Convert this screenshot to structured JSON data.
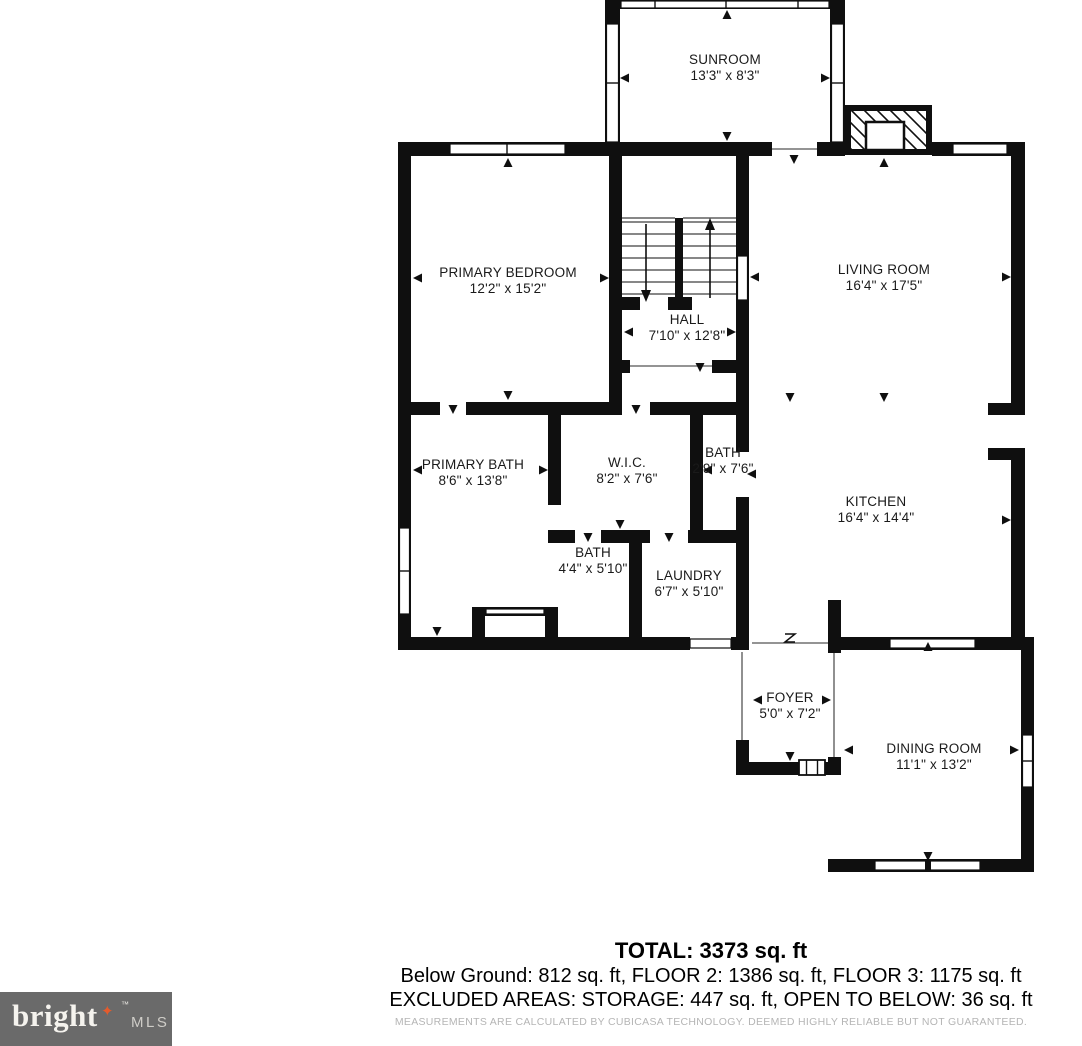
{
  "plan": {
    "rooms": [
      {
        "name": "SUNROOM",
        "dims": "13'3\" x 8'3\""
      },
      {
        "name": "PRIMARY BEDROOM",
        "dims": "12'2\" x 15'2\""
      },
      {
        "name": "LIVING ROOM",
        "dims": "16'4\" x 17'5\""
      },
      {
        "name": "HALL",
        "dims": "7'10\" x 12'8\""
      },
      {
        "name": "PRIMARY BATH",
        "dims": "8'6\" x 13'8\""
      },
      {
        "name": "W.I.C.",
        "dims": "8'2\" x 7'6\""
      },
      {
        "name": "BATH",
        "dims": "2'9\" x 7'6\""
      },
      {
        "name": "KITCHEN",
        "dims": "16'4\" x 14'4\""
      },
      {
        "name": "BATH",
        "dims": "4'4\" x 5'10\""
      },
      {
        "name": "LAUNDRY",
        "dims": "6'7\" x 5'10\""
      },
      {
        "name": "FOYER",
        "dims": "5'0\" x 7'2\""
      },
      {
        "name": "DINING ROOM",
        "dims": "11'1\" x 13'2\""
      }
    ],
    "footer": {
      "total": "TOTAL: 3373 sq. ft",
      "floors": "Below Ground: 812 sq. ft, FLOOR 2: 1386 sq. ft, FLOOR 3: 1175 sq. ft",
      "excluded": "EXCLUDED AREAS: STORAGE: 447 sq. ft, OPEN TO BELOW: 36 sq. ft",
      "disclaimer": "MEASUREMENTS ARE CALCULATED BY CUBICASA TECHNOLOGY. DEEMED HIGHLY RELIABLE BUT NOT GUARANTEED."
    },
    "logo": {
      "brand": "bright",
      "suffix": "MLS",
      "tm": "™",
      "star": "✦"
    },
    "colors": {
      "wall": "#0f0f0f",
      "accent": "#e45b2c",
      "logo_bg": "#6a6a6a",
      "text": "#1a1a1a",
      "disclaimer": "#b5b5b5"
    }
  }
}
